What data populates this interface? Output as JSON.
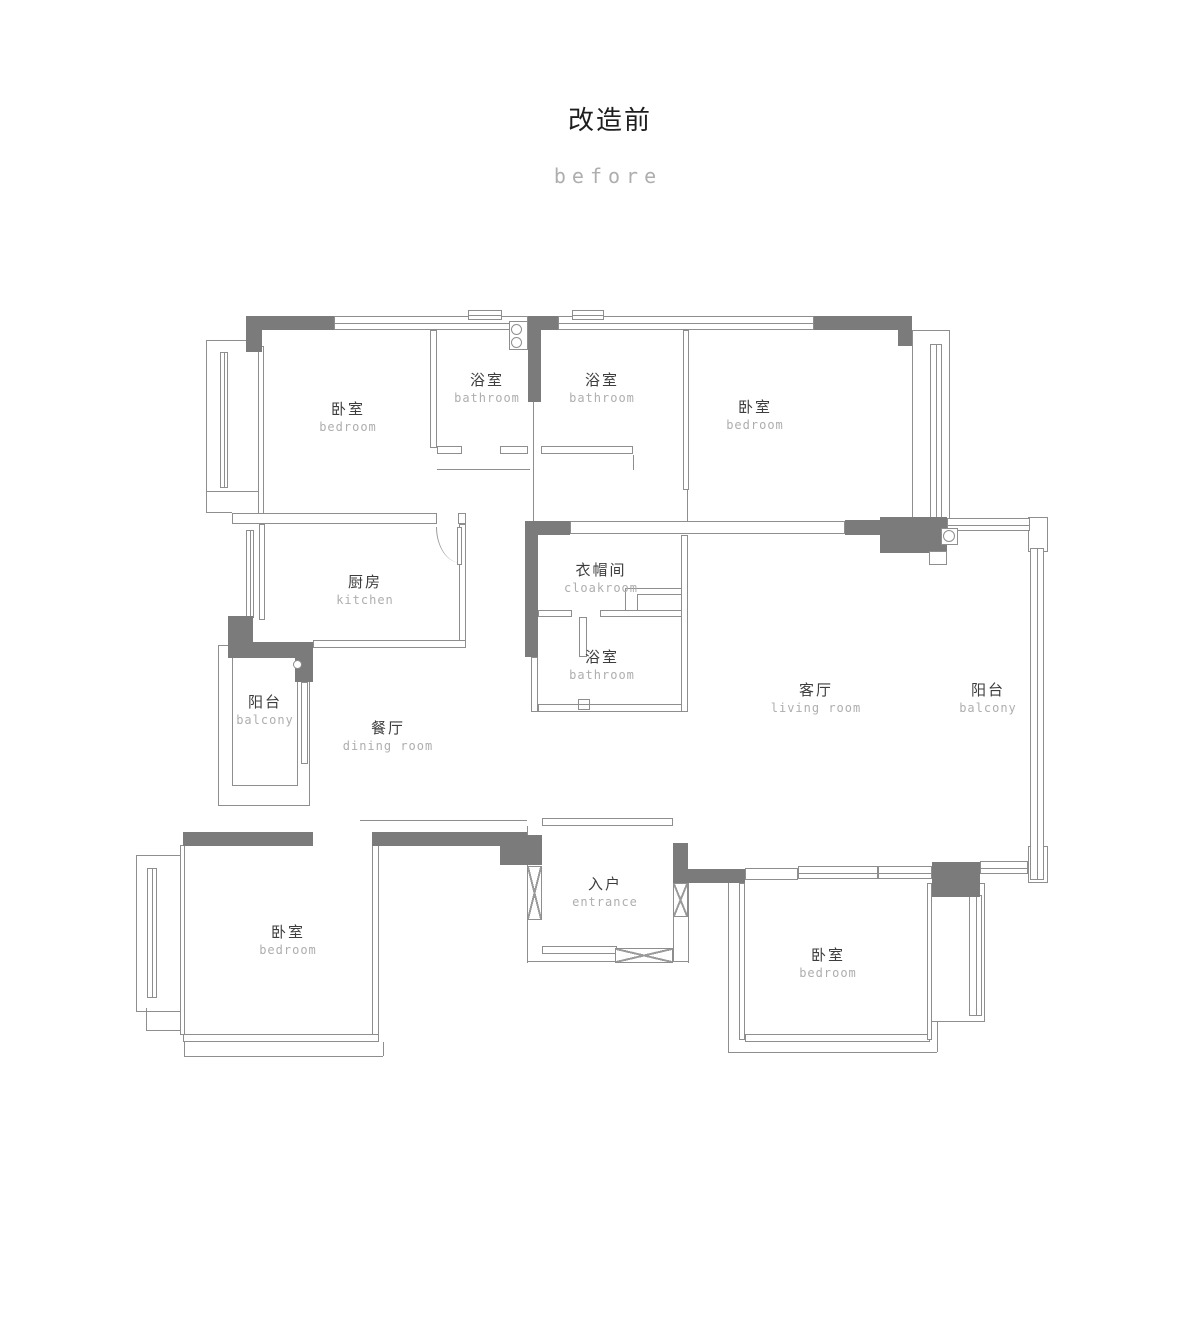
{
  "title": {
    "zh": "改造前",
    "en": "before"
  },
  "rooms": [
    {
      "id": "bedroom-top-left",
      "zh": "卧室",
      "en": "bedroom"
    },
    {
      "id": "bathroom-top-left",
      "zh": "浴室",
      "en": "bathroom"
    },
    {
      "id": "bathroom-top-middle",
      "zh": "浴室",
      "en": "bathroom"
    },
    {
      "id": "bedroom-top-right",
      "zh": "卧室",
      "en": "bedroom"
    },
    {
      "id": "kitchen",
      "zh": "厨房",
      "en": "kitchen"
    },
    {
      "id": "cloakroom",
      "zh": "衣帽间",
      "en": "cloakroom"
    },
    {
      "id": "bathroom-middle",
      "zh": "浴室",
      "en": "bathroom"
    },
    {
      "id": "living-room",
      "zh": "客厅",
      "en": "living room"
    },
    {
      "id": "balcony-right",
      "zh": "阳台",
      "en": "balcony"
    },
    {
      "id": "balcony-left",
      "zh": "阳台",
      "en": "balcony"
    },
    {
      "id": "dining-room",
      "zh": "餐厅",
      "en": "dining room"
    },
    {
      "id": "bedroom-bottom-left",
      "zh": "卧室",
      "en": "bedroom"
    },
    {
      "id": "entrance",
      "zh": "入户",
      "en": "entrance"
    },
    {
      "id": "bedroom-bottom-right",
      "zh": "卧室",
      "en": "bedroom"
    }
  ],
  "colors": {
    "structural_wall": "#7b7b7b",
    "line": "#8e8e8e",
    "label_zh": "#3d3d3d",
    "label_en": "#aeaeae"
  }
}
